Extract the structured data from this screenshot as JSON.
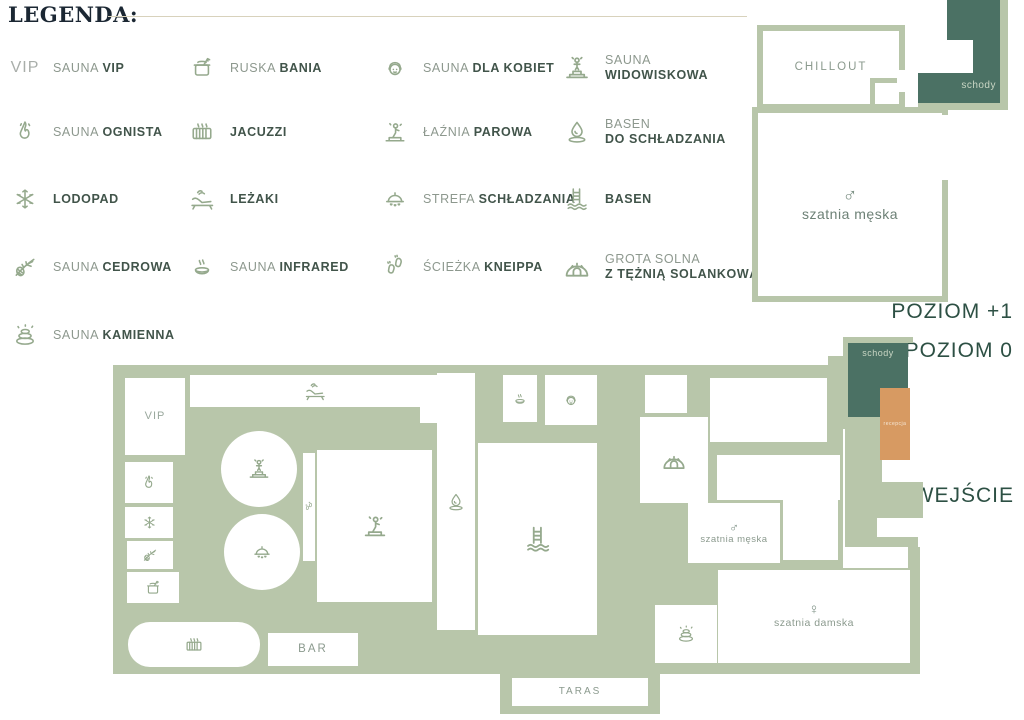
{
  "palette": {
    "sage": "#b8c6aa",
    "dark_green": "#4b7164",
    "orange": "#d79a62",
    "heading": "#1b2733",
    "legend_text": "#8d988e",
    "legend_bold": "#41544a",
    "level_text": "#2d5044",
    "icon_green": "#95a98d"
  },
  "legend": {
    "title": "LEGENDA:",
    "columns": [
      [
        {
          "id": "sauna-vip",
          "icon": "vip",
          "pre": "SAUNA",
          "bold": "VIP"
        },
        {
          "id": "sauna-ognista",
          "icon": "flame",
          "pre": "SAUNA",
          "bold": "OGNISTA"
        },
        {
          "id": "lodopad",
          "icon": "snowflake",
          "pre": "",
          "bold": "LODOPAD"
        },
        {
          "id": "sauna-cedrowa",
          "icon": "cedar",
          "pre": "SAUNA",
          "bold": "CEDROWA"
        },
        {
          "id": "sauna-kamienna",
          "icon": "stones",
          "pre": "SAUNA",
          "bold": "KAMIENNA"
        }
      ],
      [
        {
          "id": "ruska-bania",
          "icon": "bania",
          "pre": "RUSKA",
          "bold": "BANIA"
        },
        {
          "id": "jacuzzi",
          "icon": "jacuzzi",
          "pre": "",
          "bold": "JACUZZI"
        },
        {
          "id": "lezaki",
          "icon": "lounger",
          "pre": "",
          "bold": "LEŻAKI"
        },
        {
          "id": "sauna-infrared",
          "icon": "infrared",
          "pre": "SAUNA",
          "bold": "INFRARED"
        }
      ],
      [
        {
          "id": "sauna-dla-kobiet",
          "icon": "woman",
          "pre": "SAUNA",
          "bold": "DLA KOBIET"
        },
        {
          "id": "laznia-parowa",
          "icon": "parowa",
          "pre": "ŁAŹNIA",
          "bold": "PAROWA"
        },
        {
          "id": "strefa-schladzania",
          "icon": "cloche",
          "pre": "STREFA",
          "bold": "SCHŁADZANIA"
        },
        {
          "id": "sciezka-kneippa",
          "icon": "feet",
          "pre": "ŚCIEŻKA",
          "bold": "KNEIPPA"
        }
      ],
      [
        {
          "id": "sauna-widowiskowa",
          "icon": "podium-person",
          "pre": "SAUNA",
          "bold": "WIDOWISKOWA",
          "stacked": true
        },
        {
          "id": "basen-do-schladzania",
          "icon": "droplet",
          "pre": "BASEN",
          "bold": "DO SCHŁADZANIA",
          "stacked": true
        },
        {
          "id": "basen",
          "icon": "ladder",
          "pre": "",
          "bold": "BASEN"
        },
        {
          "id": "grota-solna",
          "icon": "cave",
          "pre": "GROTA SOLNA",
          "bold": "Z TĘŻNIĄ SOLANKOWĄ",
          "stacked": true
        }
      ]
    ]
  },
  "labels": {
    "poziom1": "POZIOM +1",
    "poziom0": "POZIOM 0",
    "wejscie": "WEJŚCIE"
  },
  "plan1": {
    "chillout_label": "CHILLOUT",
    "schody_label": "schody",
    "szatnia_meska_label": "szatnia męska",
    "male_symbol": "♂"
  },
  "plan0": {
    "rooms": [
      {
        "id": "vip",
        "label": "VIP"
      },
      {
        "id": "ognista",
        "icon": "flame"
      },
      {
        "id": "lodopad",
        "icon": "snowflake"
      },
      {
        "id": "cedrowa",
        "icon": "cedar"
      },
      {
        "id": "bania",
        "icon": "bania"
      },
      {
        "id": "lezaki_hall",
        "icon": "lounger"
      },
      {
        "id": "ante_top"
      },
      {
        "id": "widow_circle",
        "icon": "podium-person"
      },
      {
        "id": "schlad_circle",
        "icon": "cloche"
      },
      {
        "id": "kneippa_strip",
        "icon": "feet"
      },
      {
        "id": "parowa_room",
        "icon": "parowa"
      },
      {
        "id": "chlod_strip",
        "icon": "droplet"
      },
      {
        "id": "basen_room",
        "icon": "ladder"
      },
      {
        "id": "infrared_room",
        "icon": "infrared"
      },
      {
        "id": "kobiet_room",
        "icon": "woman"
      },
      {
        "id": "ante_tr"
      },
      {
        "id": "grota_room",
        "icon": "cave"
      },
      {
        "id": "wide_room"
      },
      {
        "id": "corr_a"
      },
      {
        "id": "corr_b"
      },
      {
        "id": "meska0",
        "symbol": "♂",
        "label": "szatnia męska"
      },
      {
        "id": "damska",
        "symbol": "♀",
        "label": "szatnia damska"
      },
      {
        "id": "kamienna_room",
        "icon": "stones"
      },
      {
        "id": "jacuzzi_bone",
        "icon": "jacuzzi"
      },
      {
        "id": "bar",
        "label": "BAR"
      },
      {
        "id": "taras",
        "label": "TARAS"
      },
      {
        "id": "schody0",
        "label": "schody"
      },
      {
        "id": "recepcja",
        "label": "recepcja"
      }
    ]
  }
}
